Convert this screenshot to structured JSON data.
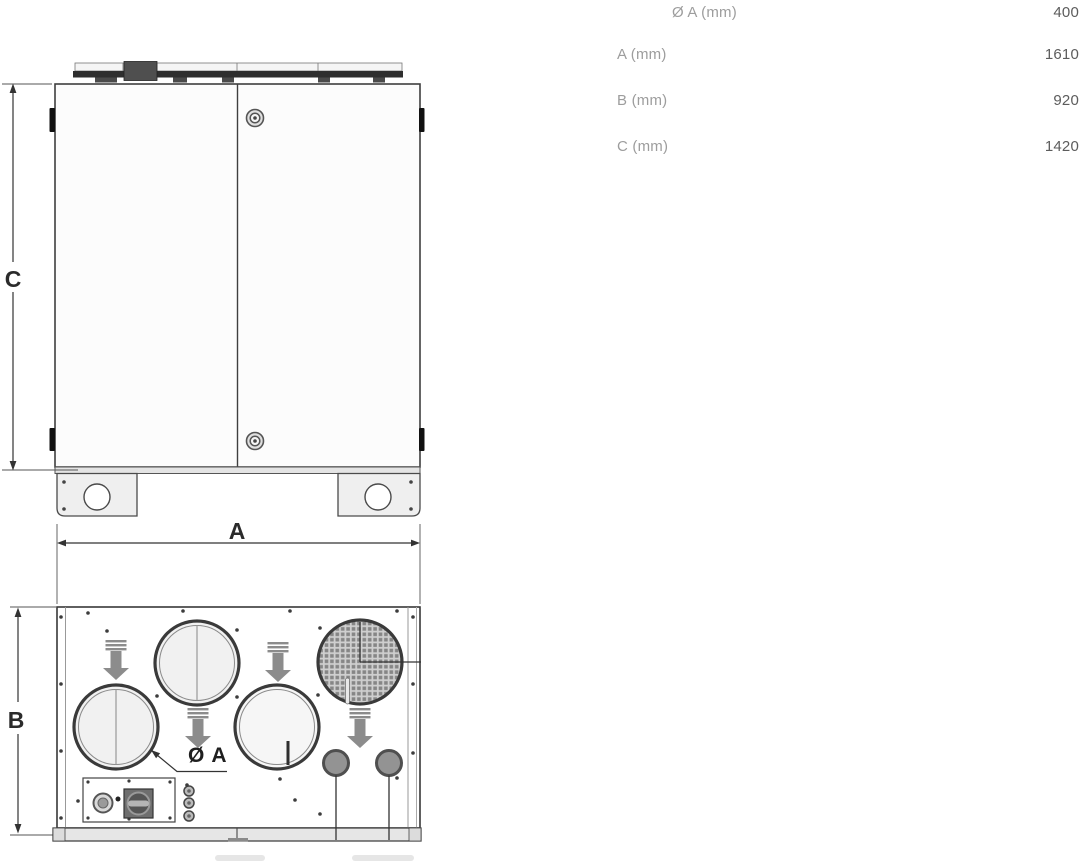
{
  "colors": {
    "drawing_line": "#3a3a3a",
    "flow_arrow_gray": "#8c8c8c",
    "table_label_gray": "#9d9d9d",
    "table_value_gray": "#5c5c5c",
    "fill_light_gray": "#f1f1f1"
  },
  "diagram": {
    "front_view": {
      "height_label": "C"
    },
    "top_view": {
      "width_label": "A",
      "depth_label": "B",
      "duct_diameter_label": "Ø A"
    },
    "icons": {
      "flow_arrow": "arrow-down",
      "grille": "mesh-circle",
      "rotary_switch": "knob-square",
      "cable_gland": "double-circle"
    }
  },
  "spec_table": {
    "rows": [
      {
        "label": "Ø A (mm)",
        "value": "400"
      },
      {
        "label": "A (mm)",
        "value": "1610"
      },
      {
        "label": "B (mm)",
        "value": "920"
      },
      {
        "label": "C (mm)",
        "value": "1420"
      }
    ]
  }
}
